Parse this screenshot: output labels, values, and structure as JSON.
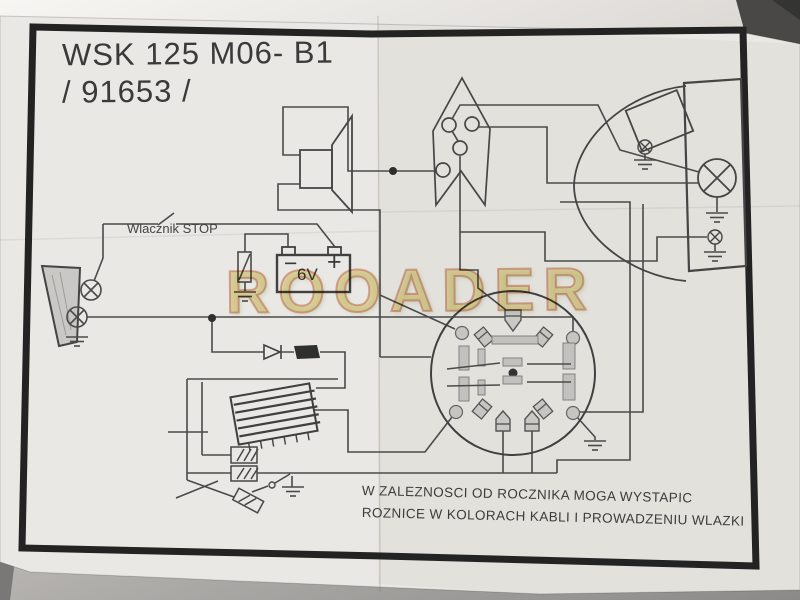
{
  "document": {
    "title_line1": "WSK 125 M06- B1",
    "title_line2": "/ 91653 /",
    "stop_switch_label": "Wlacznik STOP",
    "battery": {
      "voltage": "6V",
      "minus": "−",
      "plus": "+"
    },
    "footer_line1": "W ZALEZNOSCI OD ROCZNIKA MOGA WYSTAPIC",
    "footer_line2": "ROZNICE W KOLORACH KABLI I PROWADZENIU WLAZKI"
  },
  "watermark": {
    "text": "ROOADER"
  },
  "colors": {
    "paper": "#eae8e4",
    "ink": "#4a4a4a",
    "frame": "#222222",
    "watermark_fill": "#e7c554",
    "watermark_stroke": "#c1492f",
    "background": "#8c8a88"
  },
  "components": [
    "tail-lamp-housing",
    "brake-bulb",
    "tail-bulb",
    "stop-switch",
    "fuse",
    "battery-6v",
    "horn",
    "handlebar-switch",
    "magneto-flywheel",
    "ignition-coil",
    "rectifier-diode",
    "cable-connectors",
    "spark-plug",
    "headlamp-shell",
    "headlamp-rim",
    "speedometer",
    "speedo-bulb",
    "main-bulb",
    "parking-bulb",
    "ground-symbols"
  ]
}
